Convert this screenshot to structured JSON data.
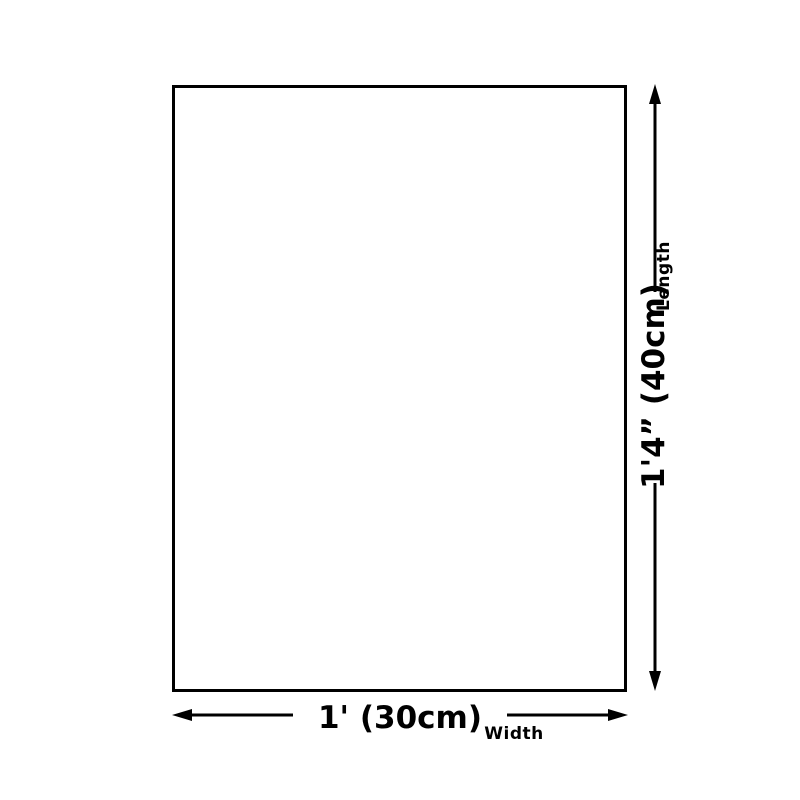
{
  "colors": {
    "background": "#ffffff",
    "line": "#000000",
    "text": "#000000"
  },
  "product": {
    "shape": "rectangle-outline"
  },
  "dimensions": {
    "length": {
      "label": "Length",
      "value": "1'4” (40cm)"
    },
    "width": {
      "label": "Width",
      "value": "1' (30cm)"
    }
  }
}
